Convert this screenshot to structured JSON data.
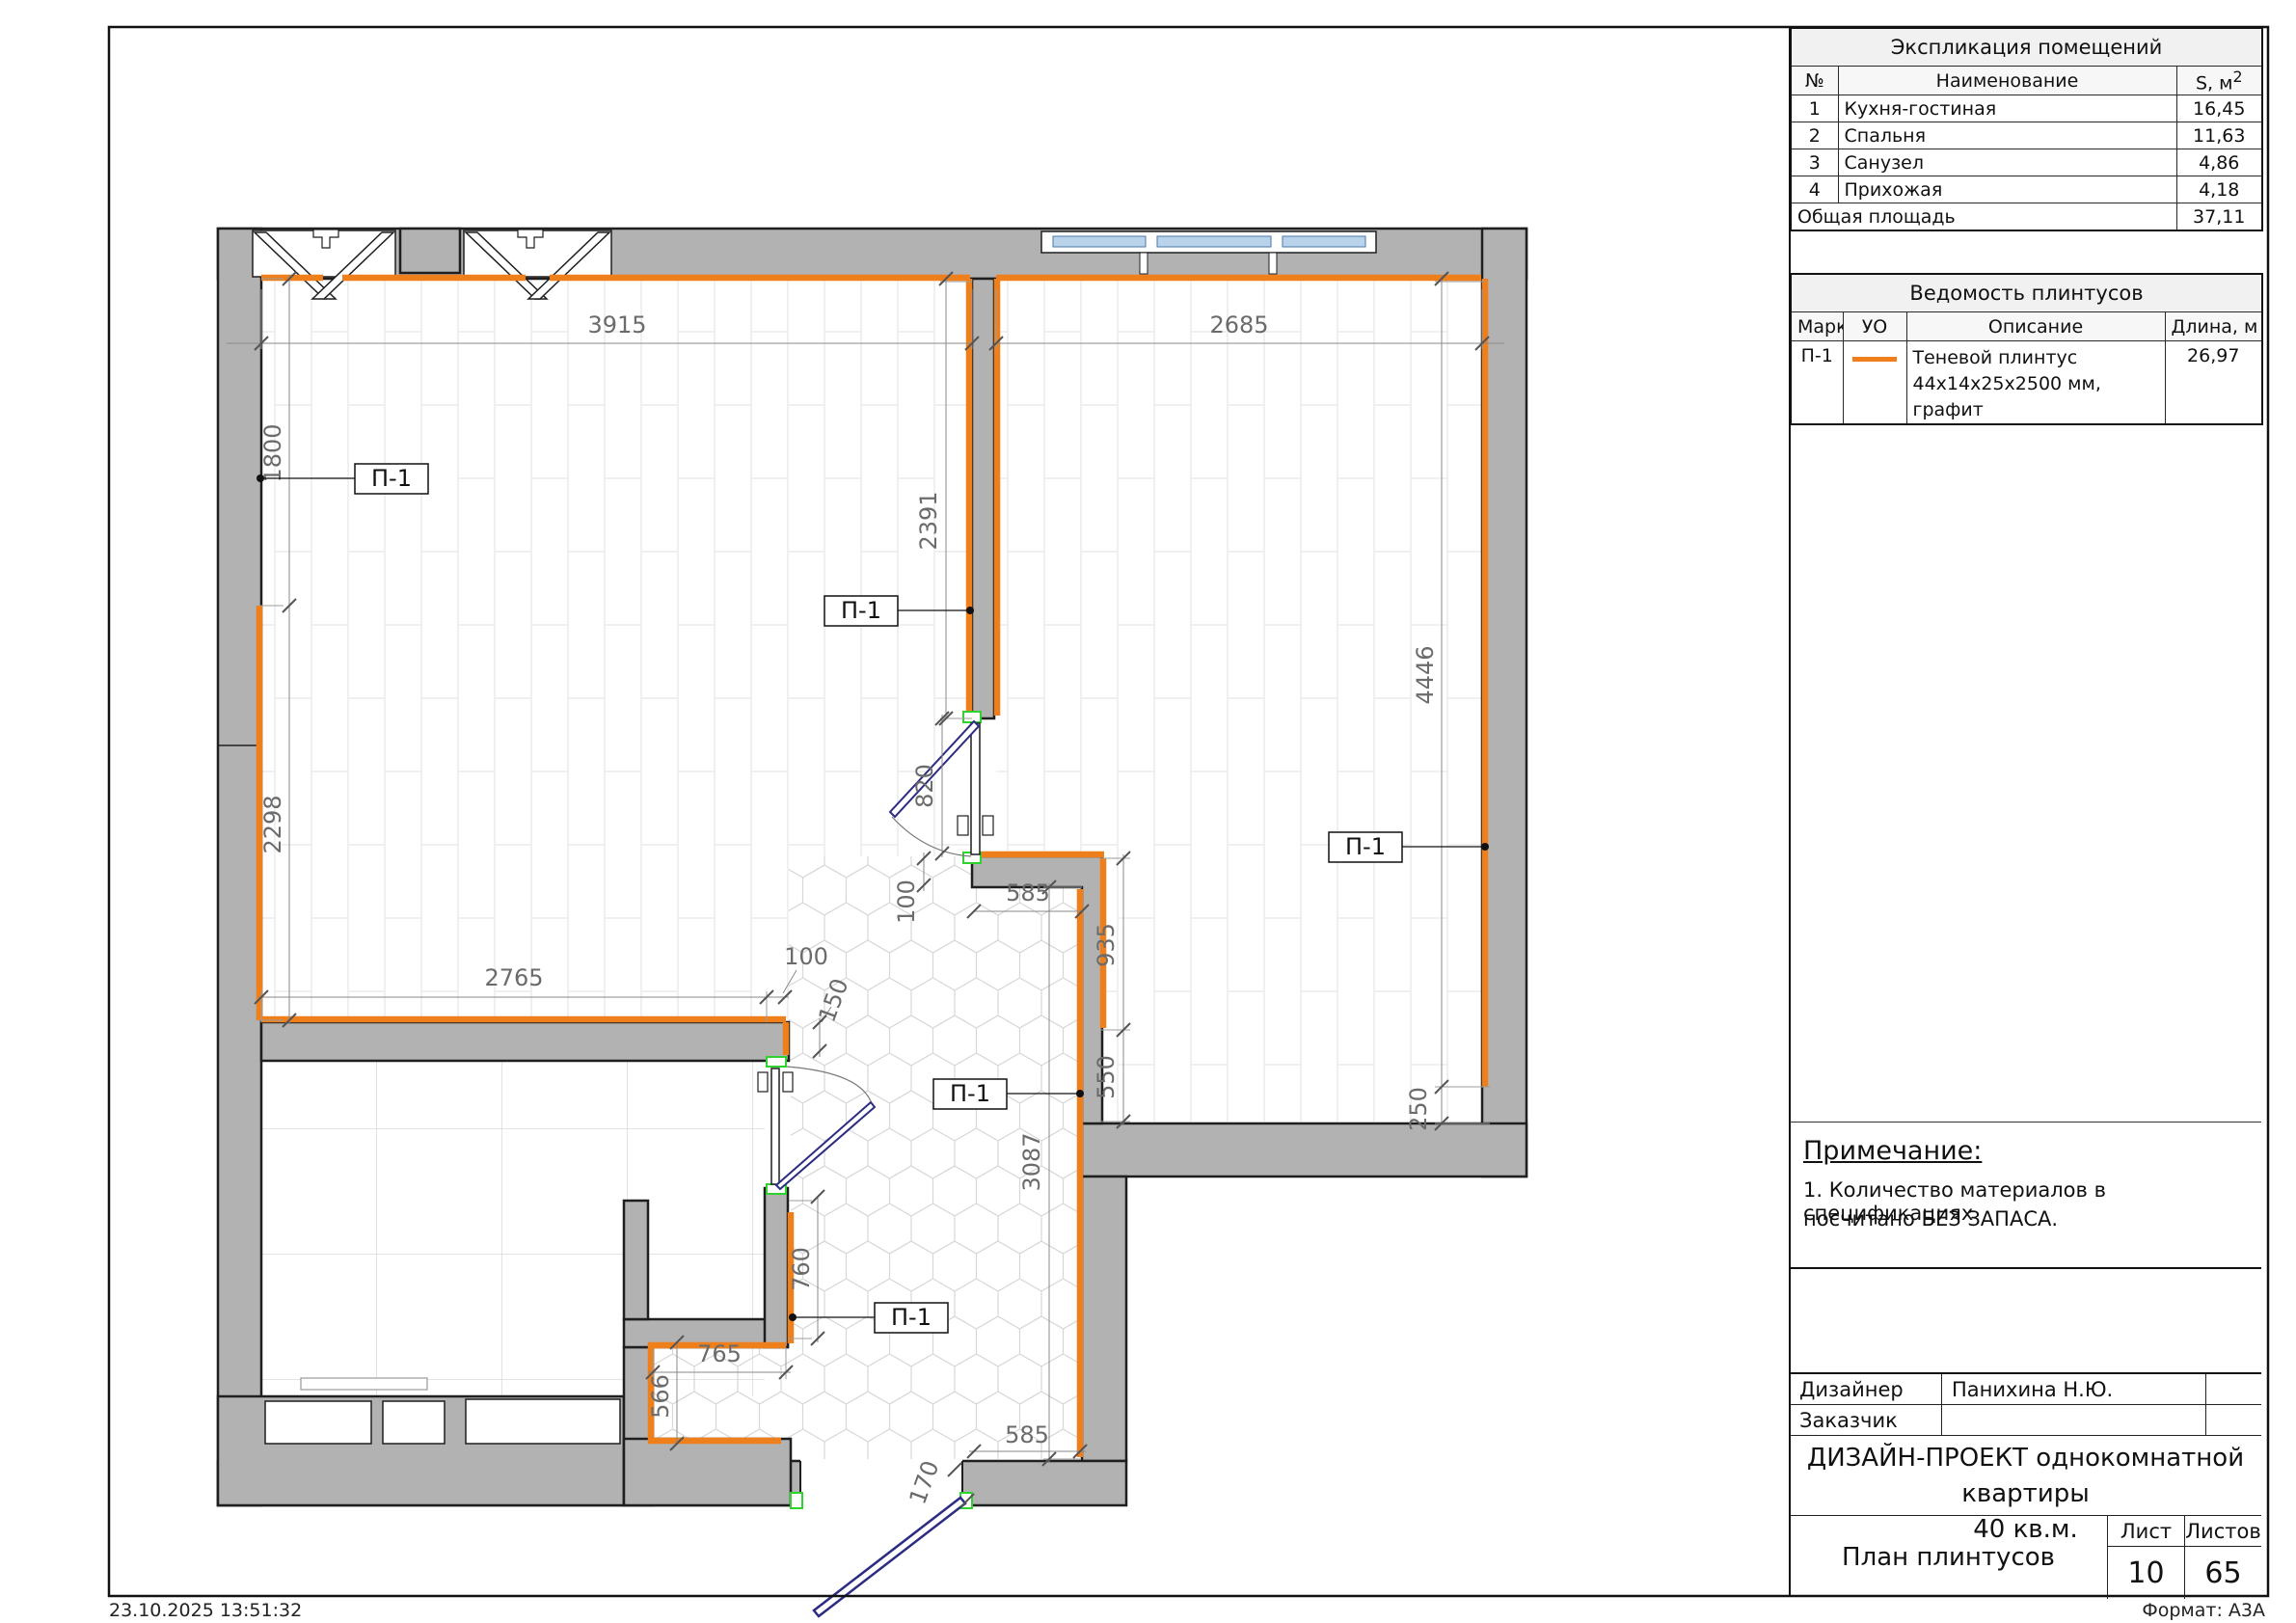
{
  "meta": {
    "timestamp": "23.10.2025 13:51:32",
    "format_label": "Формат: А3А"
  },
  "explication": {
    "title": "Экспликация помещений",
    "col_no": "№",
    "col_name": "Наименование",
    "col_area": "S, м",
    "col_area_sup": "2",
    "rows": [
      {
        "no": "1",
        "name": "Кухня-гостиная",
        "area": "16,45"
      },
      {
        "no": "2",
        "name": "Спальня",
        "area": "11,63"
      },
      {
        "no": "3",
        "name": "Санузел",
        "area": "4,86"
      },
      {
        "no": "4",
        "name": "Прихожая",
        "area": "4,18"
      }
    ],
    "total_label": "Общая площадь",
    "total_value": "37,11"
  },
  "skirting_table": {
    "title": "Ведомость плинтусов",
    "col_mark": "Марка",
    "col_uo": "УО",
    "col_desc": "Описание",
    "col_len": "Длина, м",
    "rows": [
      {
        "mark": "П-1",
        "desc_line1": "Теневой плинтус",
        "desc_line2": "44х14х25х2500 мм, графит",
        "length": "26,97"
      }
    ]
  },
  "note": {
    "title": "Примечание:",
    "line1": "1. Количество материалов в спецификациях",
    "line2": "посчитано БЕЗ ЗАПАСА."
  },
  "title_block": {
    "designer_label": "Дизайнер",
    "designer_name": "Панихина Н.Ю.",
    "client_label": "Заказчик",
    "client_name": "",
    "project_title_line1": "ДИЗАЙН-ПРОЕКТ однокомнатной квартиры",
    "project_title_line2": "40 кв.м.",
    "sheet_name": "План плинтусов",
    "sheet_label": "Лист",
    "sheets_label": "Листов",
    "sheet_number": "10",
    "sheets_total": "65"
  },
  "plan": {
    "skirting_mark": "П-1",
    "dims": {
      "d3915": "3915",
      "d2685": "2685",
      "d1800": "1800",
      "d2298": "2298",
      "d2391": "2391",
      "d4446": "4446",
      "d820": "820",
      "d100_hall": "100",
      "d585_hall": "585",
      "d935": "935",
      "d550": "550",
      "d3087": "3087",
      "d2765": "2765",
      "d100_chain": "100",
      "d150": "150",
      "d760": "760",
      "d765": "765",
      "d566": "566",
      "d585_entry": "585",
      "d170": "170",
      "d250": "250"
    },
    "colors": {
      "skirting": "#ef7f1a",
      "wall_fill": "#b2b2b2",
      "wall_outline": "#1f1f1f",
      "door_leaf_blue": "#2c2c83",
      "door_frame_green": "#2ed32e",
      "glazing_blue": "#b8d3ea"
    }
  }
}
